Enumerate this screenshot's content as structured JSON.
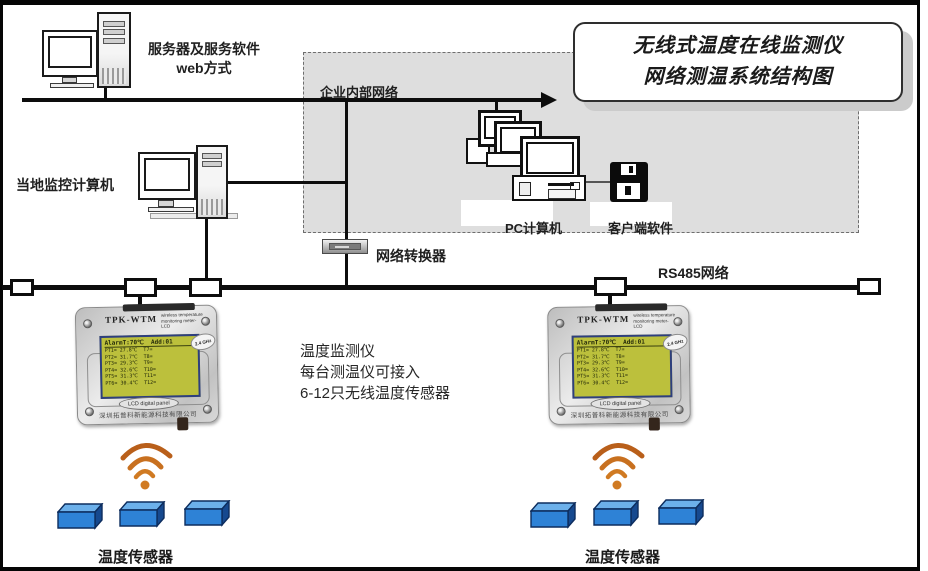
{
  "title": {
    "line1": "无线式温度在线监测仪",
    "line2": "网络测温系统结构图"
  },
  "server_label": {
    "line1": "服务器及服务软件",
    "line2": "web方式"
  },
  "intranet_label": "企业内部网络",
  "local_pc_label": "当地监控计算机",
  "pc_label": "PC计算机",
  "client_label": "客户端软件",
  "converter_label": "网络转换器",
  "rs485_label": "RS485网络",
  "note": {
    "line1": "温度监测仪",
    "line2": "每台测温仪可接入",
    "line3": "6-12只无线温度传感器"
  },
  "sensors": {
    "left_label": "温度传感器",
    "right_label": "温度传感器"
  },
  "device": {
    "model": "TPK-WTM",
    "subtitle": "wireless temperature monitoring meter-LCD",
    "badge": "2.4 GHz",
    "lcd_header": "AlarmT:70℃  Add:01",
    "lcd_rows": [
      "PT1= 27.8℃  T7=",
      "PT2= 31.7℃  T8=",
      "PT3= 29.3℃  T9=",
      "PT4= 32.6℃  T10=",
      "PT5= 31.3℃  T11=",
      "PT6= 30.4℃  T12="
    ],
    "panel_label": "LCD digital panel",
    "company": "深圳拓普科新能源科技有限公司"
  },
  "colors": {
    "accent_orange": "#c9701f",
    "sensor_blue": "#2b7fd4",
    "lcd_bg": "#bcc03c",
    "zone_gray": "#dedede"
  }
}
